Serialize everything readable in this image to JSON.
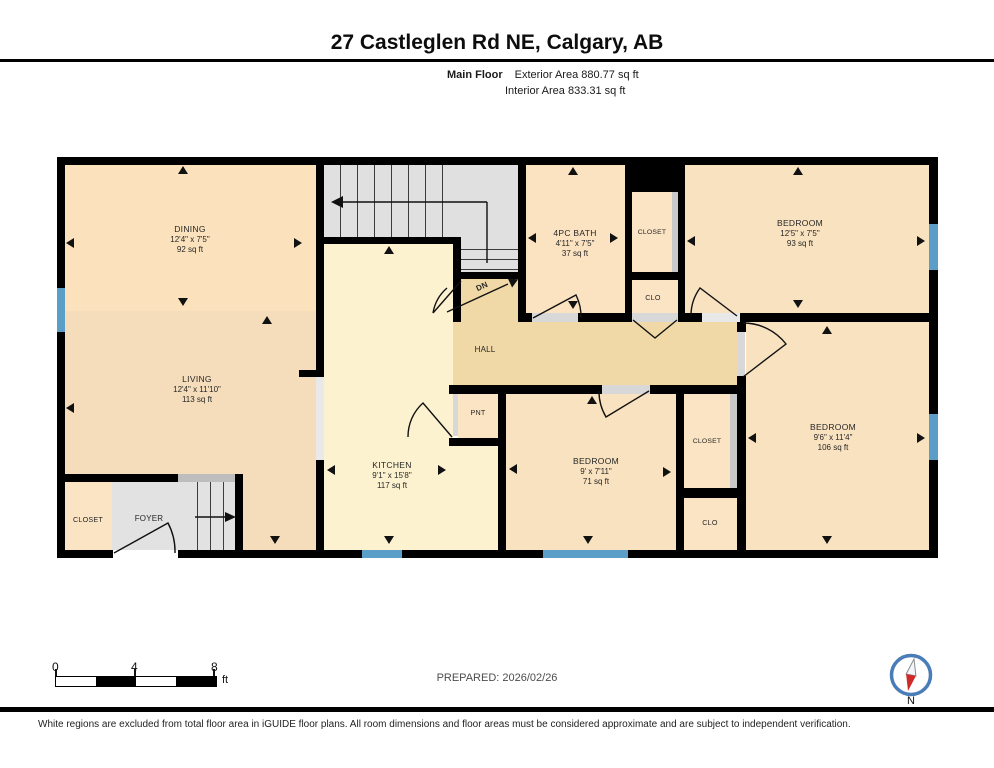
{
  "header": {
    "title": "27 Castleglen Rd NE, Calgary, AB",
    "floor_label": "Main Floor",
    "exterior_area": "Exterior Area 880.77 sq ft",
    "interior_area": "Interior Area 833.31 sq ft"
  },
  "rooms": {
    "dining": {
      "name": "DINING",
      "dims": "12'4\" x 7'5\"",
      "area": "92 sq ft"
    },
    "living": {
      "name": "LIVING",
      "dims": "12'4\" x 11'10\"",
      "area": "113 sq ft"
    },
    "kitchen": {
      "name": "KITCHEN",
      "dims": "9'1\" x 15'8\"",
      "area": "117 sq ft"
    },
    "bath": {
      "name": "4PC BATH",
      "dims": "4'11\" x 7'5\"",
      "area": "37 sq ft"
    },
    "bedroom_top_right": {
      "name": "BEDROOM",
      "dims": "12'5\" x 7'5\"",
      "area": "93 sq ft"
    },
    "bedroom_right": {
      "name": "BEDROOM",
      "dims": "9'6\" x 11'4\"",
      "area": "106 sq ft"
    },
    "bedroom_center": {
      "name": "BEDROOM",
      "dims": "9' x 7'11\"",
      "area": "71 sq ft"
    },
    "hall": {
      "name": "HALL"
    },
    "foyer": {
      "name": "FOYER"
    },
    "pantry": {
      "name": "PNT"
    },
    "closet_entry": {
      "name": "CLOSET"
    },
    "closet_top": {
      "name": "CLOSET"
    },
    "clo_top": {
      "name": "CLO"
    },
    "closet_mid": {
      "name": "CLOSET"
    },
    "clo_mid": {
      "name": "CLO"
    },
    "stairs_down_label": "DN"
  },
  "footer": {
    "scale_ticks": [
      "0",
      "4",
      "8"
    ],
    "scale_unit": "ft",
    "prepared": "PREPARED: 2026/02/26",
    "compass_north_label": "N",
    "disclaimer": "White regions are excluded from total floor area in iGUIDE floor plans. All room dimensions and floor areas must be considered approximate and are subject to independent verification."
  },
  "colors": {
    "wall": "#000000",
    "window": "#5b9ec8",
    "room_peach": "#f9e2c0",
    "kitchen_yellow": "#fdf2d0",
    "hall_tan": "#f0d9a7",
    "stairs_gray": "#e0e0e0",
    "compass_ring_blue": "#4a7db8",
    "compass_needle_red": "#cf2a27"
  }
}
